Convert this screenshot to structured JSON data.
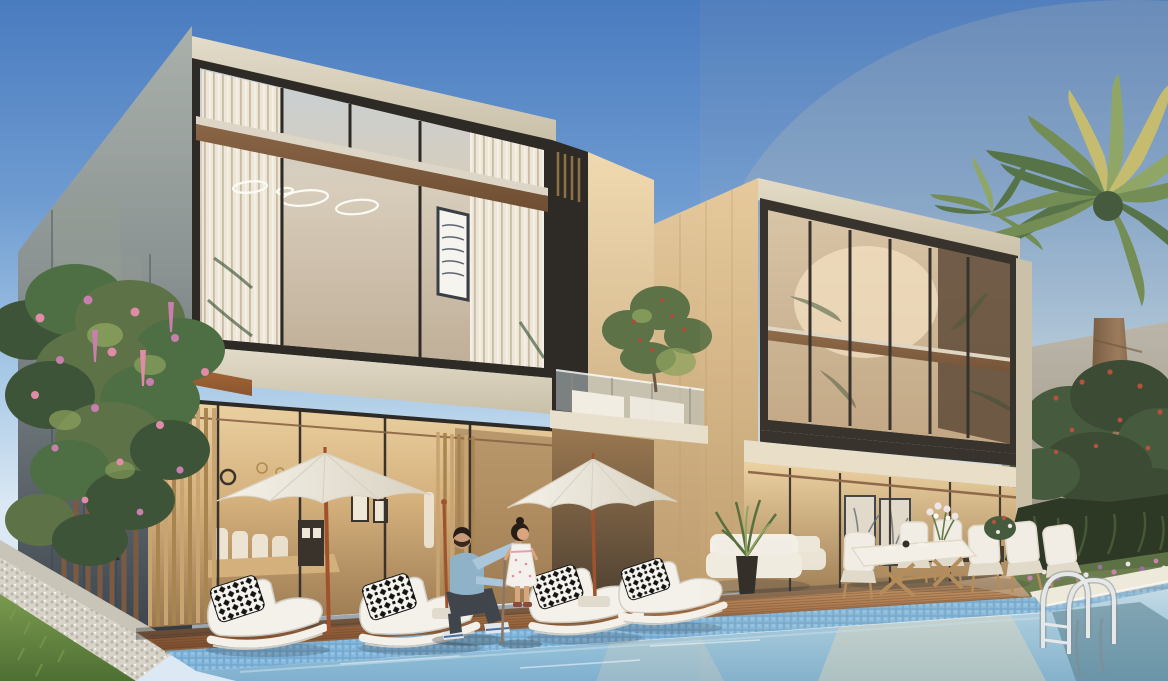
{
  "scene": {
    "description": "Architectural rendering of two modern luxury villas with floor-to-ceiling glazing, a wooden pool deck with white sun loungers and patio umbrellas, a turquoise swimming pool with chrome ladder, an outdoor dining set, a man kneeling with a little girl, date palms and a pink flowering tree",
    "elements": [
      "sky",
      "villa-left",
      "villa-right",
      "middle-balcony",
      "swimming-pool",
      "pool-ladder",
      "wooden-deck",
      "stone-patio",
      "sun-loungers",
      "patio-umbrellas",
      "outdoor-dining-set",
      "man-kneeling",
      "girl-standing",
      "date-palm",
      "flowering-tree",
      "garden-hedge",
      "flower-bed",
      "lawn",
      "pebble-border",
      "boundary-wall",
      "outdoor-sofa",
      "potted-plant"
    ]
  },
  "palette": {
    "sky_top": "#497bbf",
    "sky_mid": "#6f9cd1",
    "sky_low": "#a8c9e6",
    "sky_horizon": "#dce9f4",
    "sun_glow": "#ffd9a0",
    "wall_light": "#aab1ab",
    "wall_mid": "#8a9292",
    "wall_dark": "#39424c",
    "wall_panel": "#949c93",
    "parapet": "#e3dcc9",
    "parapet_dark": "#c9c0a9",
    "frame_dark": "#2e2b26",
    "glass_sky": "#c6d0d6",
    "glass_warm": "#d8cdbb",
    "glass_deep": "#bfae97",
    "curtain": "#eee7d8",
    "curtain_shadow": "#c9bca6",
    "band_cream": "#ddd6c6",
    "band_wood": "#8a6546",
    "band_wood_dark": "#6e4e33",
    "copper": "#b06a38",
    "copper_dark": "#8a5630",
    "interior_light": "#ecd2a2",
    "interior_mid": "#d4b07c",
    "interior_dark": "#9a7850",
    "recess_dark": "#4e4032",
    "cabinet_dark": "#3a332c",
    "brass": "#b08c4e",
    "art_frame": "#3a3f45",
    "art_lines": "#5a6670",
    "ring_white": "#fbfbf6",
    "slat_wood": "#c9a473",
    "slat_dark": "#a8854f",
    "fin_brown": "#7a5a40",
    "travertine": "#e5c99c",
    "travertine_dark": "#bd9c6e",
    "travertine_light": "#f0d9b0",
    "balcony_glass": "#bcc8cc",
    "planter_white": "#f1ede2",
    "olive_green": "#5d7247",
    "olive_light": "#8da35e",
    "berry_red": "#b44a3c",
    "glassr_warm": "#d6c3a8",
    "glassr_deep": "#bfa583",
    "interior_shadow": "#574434",
    "arch_glow": "#f3e2c4",
    "soffit": "#e8e0cc",
    "gray_wall": "#b8b4aa",
    "gray_wall_dark": "#8e897d",
    "window_glow": "#d89a58",
    "palm_green": "#4e6e44",
    "palm_mid": "#6d8a52",
    "palm_light": "#8aa465",
    "palm_sunlit": "#c2bb6e",
    "trunk_light": "#97775a",
    "trunk_dark": "#6b5138",
    "tree_dark": "#32452f",
    "tree_mid": "#3d5438",
    "flower_red": "#b04a3a",
    "hedge": "#22301f",
    "agave": "#3b5232",
    "bed_pink": "#c87fae",
    "bed_white": "#ece6ea",
    "bed_purple": "#9a6aa8",
    "bed_green": "#5a7444",
    "grass_light": "#7a9a4f",
    "grass_dark": "#4e6f33",
    "pebble": "#d9d4ca",
    "pebble_dot": "#bab4a6",
    "curb": "#c9c4b8",
    "deck_light": "#c59769",
    "deck_mid": "#9e6b43",
    "deck_dark": "#7a4c2d",
    "deck_line": "#5f3c26",
    "deck_trim": "#8a6647",
    "patio_light": "#d8bb94",
    "patio_dark": "#b29070",
    "tile_blue": "#85b8dc",
    "tile_light": "#9ac8e6",
    "tile_dark": "#6fa4cc",
    "coping": "#eceadf",
    "water_light": "#c2dcea",
    "water_mid": "#9dc6dd",
    "water_deep": "#7fb0ce",
    "water_refl_dark": "#4e7a8a",
    "water_refl_warm": "#e8d9ba",
    "chrome": "#e4e9ec",
    "chrome_shadow": "#7d868c",
    "umbrella": "#f5f2ea",
    "umbrella_shade": "#d9d2c2",
    "pole_wood": "#a0522d",
    "lounger": "#f3f1ea",
    "lounger_shadow": "#cfccc4",
    "pillow_black": "#141414",
    "pillow_white": "#f6f4ee",
    "chair_white": "#f1efe8",
    "chair_shadow": "#e0dbcd",
    "table_wood": "#b08a58",
    "skin": "#c99b78",
    "hair": "#261e16",
    "denim": "#8fb2c9",
    "denim_light": "#a9c6da",
    "pants": "#40454c",
    "sneaker": "#e2e7ea",
    "sneaker_blue": "#4a6fa5",
    "girl_skin": "#d8a57f",
    "dress": "#f4f1ec",
    "dress_pink": "#e08ca8",
    "shoe_brown": "#8a4a3c",
    "stick": "#8a7664",
    "sofa_white": "#efece2",
    "pot_black": "#2a2622",
    "plant_green": "#4e6b38",
    "shadow": "#262b30"
  }
}
